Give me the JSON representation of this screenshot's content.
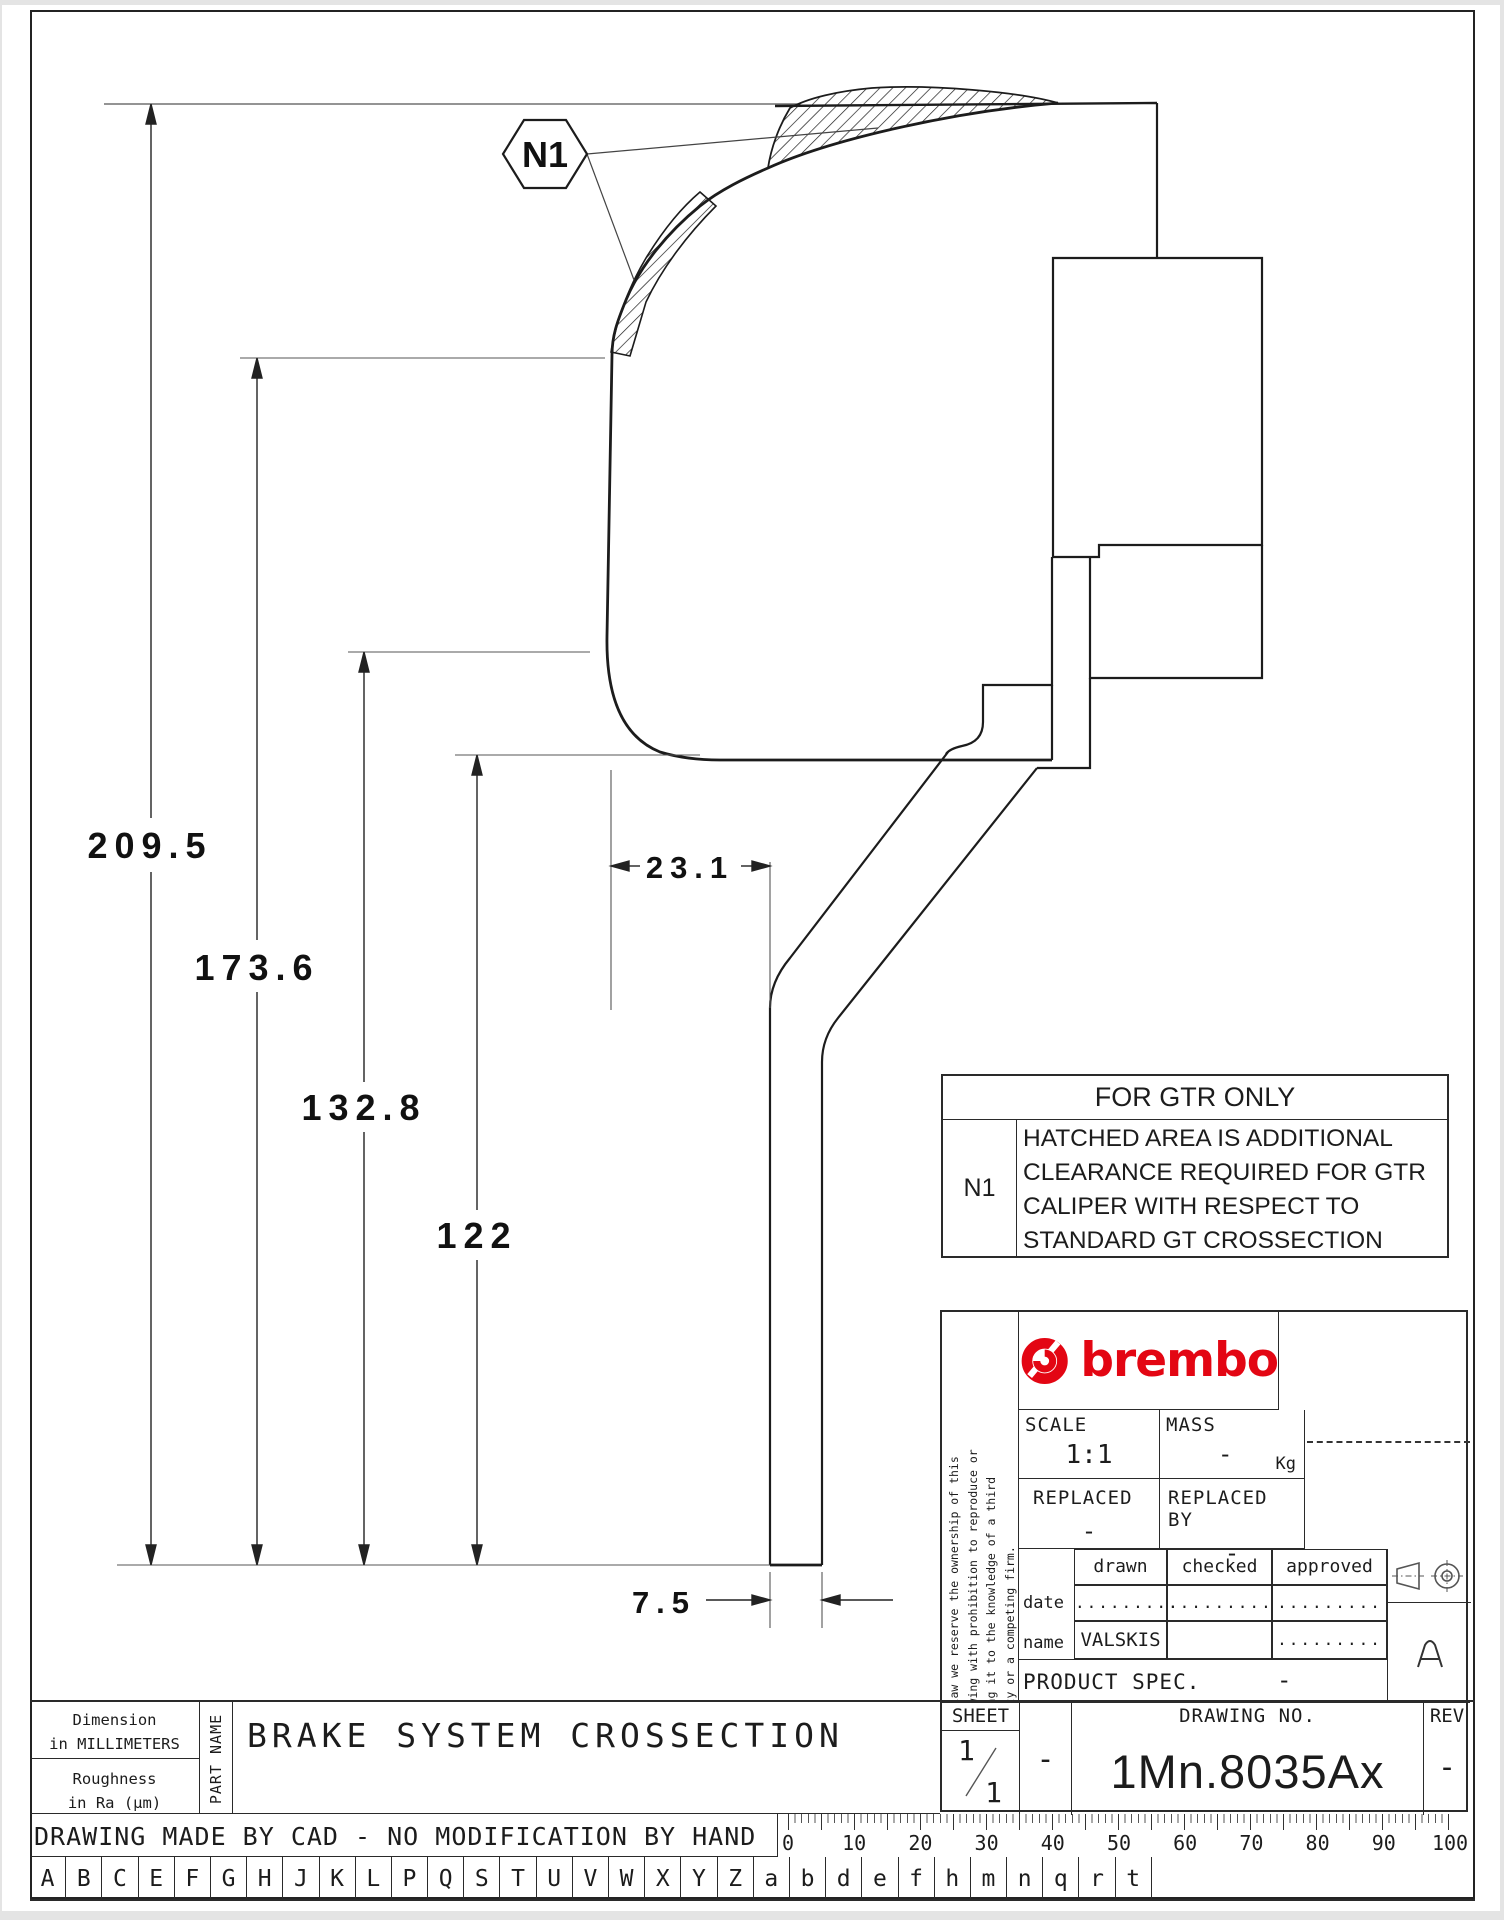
{
  "colors": {
    "ink": "#1c1c1c",
    "thin": "#555555",
    "brand_red": "#e30613",
    "paper": "#ffffff"
  },
  "drawing": {
    "balloon_label": "N1",
    "dim_overall": "209.5",
    "dim_2": "173.6",
    "dim_3": "132.8",
    "dim_4": "122",
    "dim_offset": "23.1",
    "dim_thickness": "7.5"
  },
  "gtr_table": {
    "title": "FOR GTR ONLY",
    "ref": "N1",
    "lines": [
      "HATCHED AREA IS ADDITIONAL",
      "CLEARANCE REQUIRED FOR GTR",
      "CALIPER WITH RESPECT TO",
      "STANDARD GT CROSSECTION"
    ]
  },
  "title_block": {
    "disclaimer_lines": [
      "By law we reserve the ownership of this",
      "drawing with prohibition to reproduce or",
      "bring it to the knowledge of a third",
      "party or a competing firm."
    ],
    "brand": "brembo",
    "scale_label": "SCALE",
    "scale_value": "1:1",
    "mass_label": "MASS",
    "mass_value": "-",
    "mass_unit": "Kg",
    "replaced_label": "REPLACED",
    "replaced_value": "-",
    "replaced_by_label": "REPLACED BY",
    "replaced_by_value": "-",
    "sig_cols": [
      "drawn",
      "checked",
      "approved"
    ],
    "date_label": "date",
    "date_values": [
      ".........",
      ".........",
      "........."
    ],
    "name_label": "name",
    "name_values": [
      "VALSKIS",
      "",
      "........."
    ],
    "product_label": "PRODUCT SPEC.",
    "product_value": "-",
    "sheet_label": "SHEET",
    "sheet_num": "1",
    "sheet_den": "1",
    "sheet_dash": "-",
    "drawing_no_label": "DRAWING NO.",
    "drawing_no": "1Mn.8035Ax",
    "rev_label": "REV",
    "rev_value": "-",
    "format_letter": "A"
  },
  "footer": {
    "dim_line1": "Dimension",
    "dim_line2": "in MILLIMETERS",
    "rough_line1": "Roughness",
    "rough_line2": "in Ra (µm)",
    "part_name_label": "PART NAME",
    "part_name": "BRAKE SYSTEM CROSSECTION",
    "cad_note": "DRAWING MADE BY CAD - NO MODIFICATION BY HAND",
    "ruler_numbers": [
      "0",
      "10",
      "20",
      "30",
      "40",
      "50",
      "60",
      "70",
      "80",
      "90",
      "100"
    ],
    "letters": [
      "A",
      "B",
      "C",
      "E",
      "F",
      "G",
      "H",
      "J",
      "K",
      "L",
      "P",
      "Q",
      "S",
      "T",
      "U",
      "V",
      "W",
      "X",
      "Y",
      "Z",
      "a",
      "b",
      "d",
      "e",
      "f",
      "h",
      "m",
      "n",
      "q",
      "r",
      "t"
    ]
  }
}
